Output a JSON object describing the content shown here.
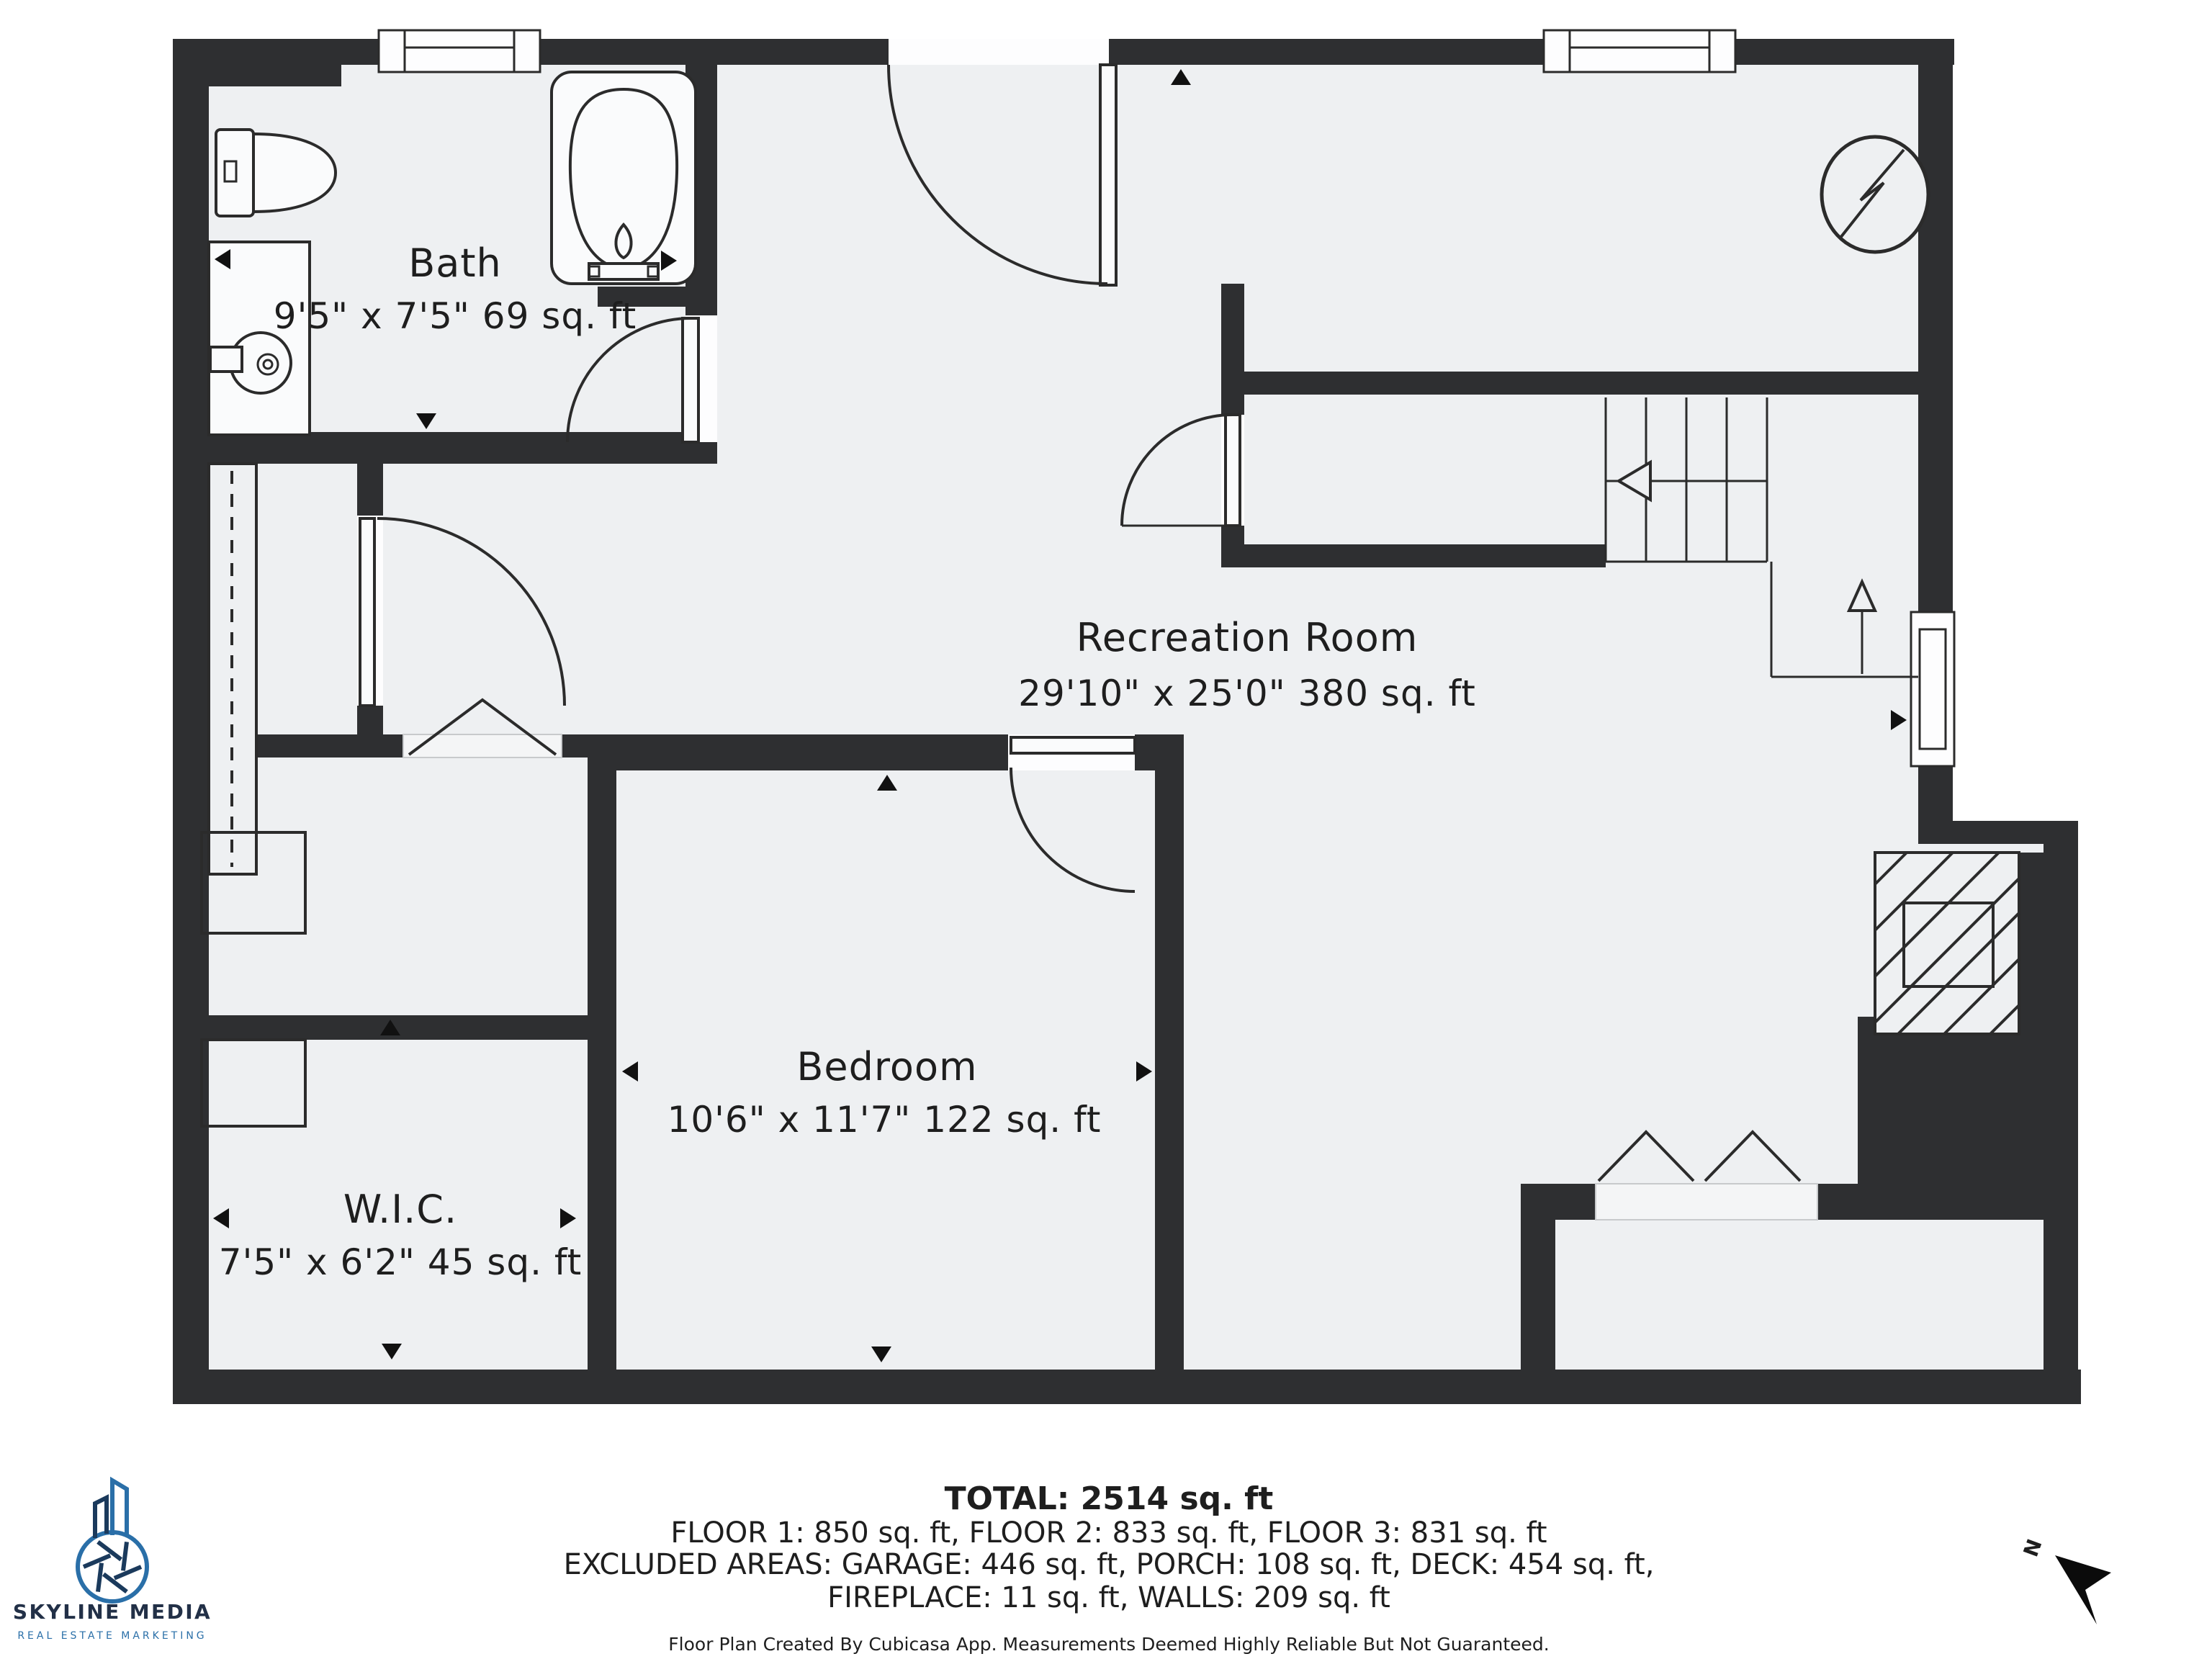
{
  "rooms": {
    "bath": {
      "name": "Bath",
      "dims": "9'5\" x 7'5\" 69 sq. ft"
    },
    "recreation": {
      "name": "Recreation Room",
      "dims": "29'10\" x 25'0\" 380 sq. ft"
    },
    "bedroom": {
      "name": "Bedroom",
      "dims": "10'6\" x 11'7\" 122 sq. ft"
    },
    "wic": {
      "name": "W.I.C.",
      "dims": "7'5\" x 6'2\" 45 sq. ft"
    }
  },
  "summary": {
    "total": "TOTAL: 2514 sq. ft",
    "floors": "FLOOR 1: 850 sq. ft, FLOOR 2: 833 sq. ft, FLOOR 3: 831 sq. ft",
    "excluded1": "EXCLUDED AREAS: GARAGE: 446 sq. ft, PORCH: 108 sq. ft, DECK: 454 sq. ft,",
    "excluded2": "FIREPLACE: 11 sq. ft, WALLS: 209 sq. ft",
    "disclaimer": "Floor Plan Created By Cubicasa App. Measurements Deemed Highly Reliable But Not Guaranteed."
  },
  "branding": {
    "logo_title": "SKYLINE MEDIA",
    "logo_subtitle": "REAL ESTATE MARKETING"
  },
  "compass": {
    "label": "N"
  },
  "colors": {
    "wall": "#2e2f31",
    "floor": "#eef0f2",
    "logo_blue": "#2a6fa8",
    "logo_navy": "#223047"
  }
}
